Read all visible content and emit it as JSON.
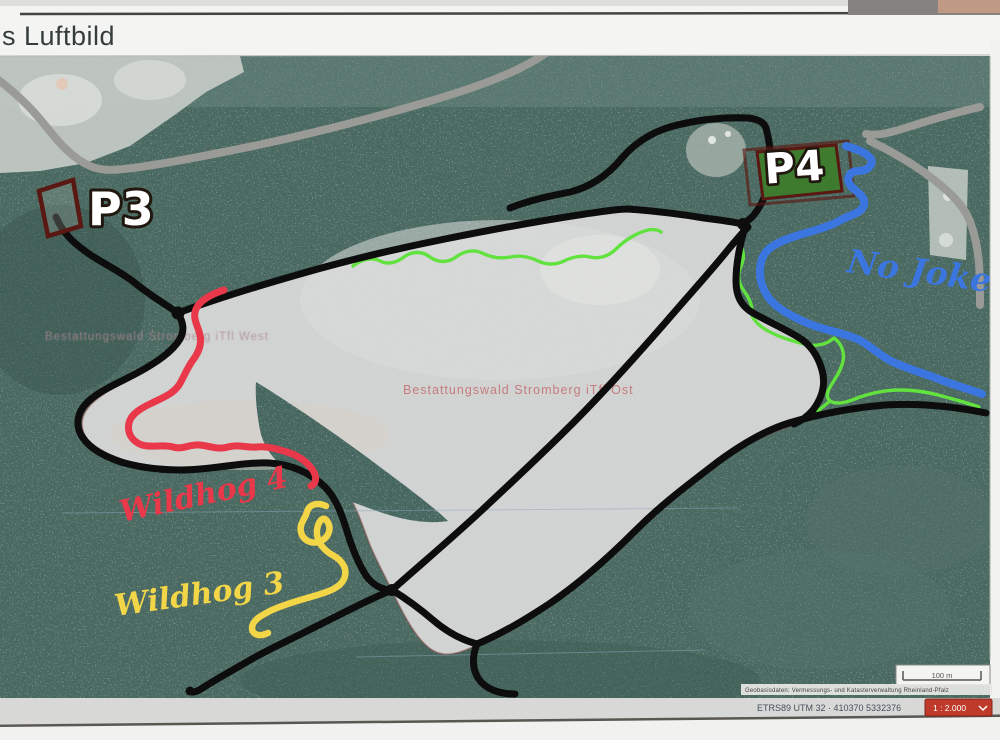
{
  "photo": {
    "title": "s Luftbild"
  },
  "map_labels": {
    "p3": "P3",
    "p4": "P4",
    "forest_west": "Bestattungswald Stromberg iTfl West",
    "forest_ost": "Bestattungswald Stromberg iTfl Ost"
  },
  "trails": {
    "wildhog4": {
      "label": "Wildhog 4",
      "color": "#e8384a"
    },
    "wildhog3": {
      "label": "Wildhog 3",
      "color": "#f3d648"
    },
    "no_jokes": {
      "label": "No Jokes",
      "color": "#3b76e0"
    },
    "main_color": "#0d0d0d",
    "road_color": "#9a9a96",
    "connector_color": "#62e23e",
    "parking_fill": "#3e7b2e",
    "parking_outline": "#5a1812"
  },
  "footer": {
    "scale_bar": "100 m",
    "attribution": "Geobasisdaten: Vermessungs- und Katasterverwaltung Rheinland-Pfalz",
    "coordinates": "ETRS89 UTM 32 · 410370 5332376",
    "scale_select": "1 : 2.000"
  }
}
